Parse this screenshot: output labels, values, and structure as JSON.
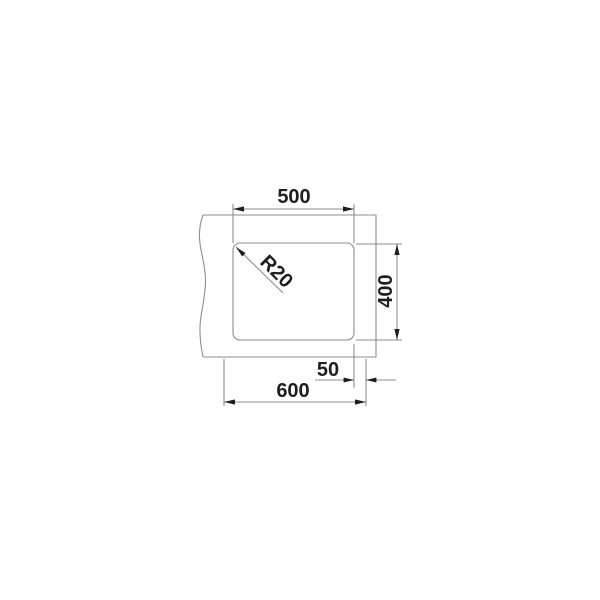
{
  "drawing": {
    "labels": {
      "bowl_width": "500",
      "bowl_depth": "400",
      "rim_offset": "50",
      "overall_width": "600",
      "corner_radius": "R20"
    },
    "colors": {
      "line": "#8a8e91",
      "ink": "#1e1e1e",
      "background": "#ffffff"
    }
  }
}
